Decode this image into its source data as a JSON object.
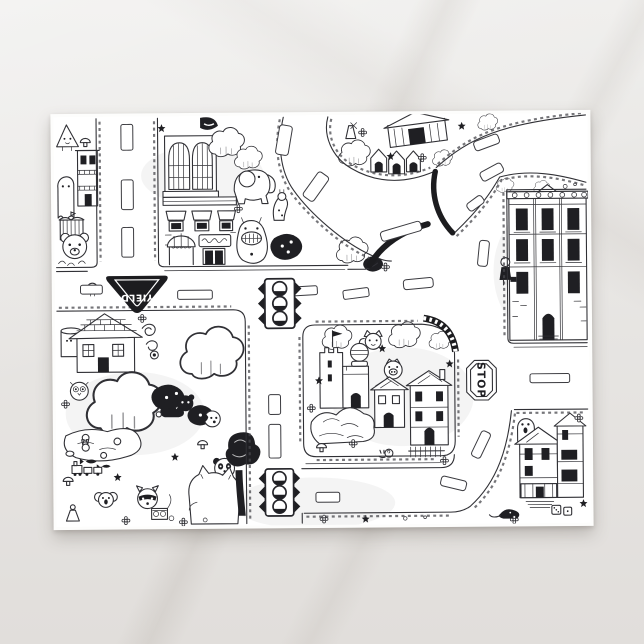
{
  "scene": {
    "type": "postcard product photo",
    "background_surface": "light marble countertop",
    "postcard": {
      "artwork_style": "black ink doodle road map of a whimsical town",
      "ink_color": "#1f1f23",
      "paper_color": "#ffffff",
      "signs": {
        "yield": "YIELD",
        "stop": "STOP"
      },
      "road_features": [
        "outlined dashed lane markings",
        "cobblestone curb ticks",
        "two traffic lights",
        "upside-down yield sign",
        "sideways stop octagon",
        "curved boulevard forking to the right edge",
        "right-angle turn to bottom road"
      ],
      "landmarks": [
        "gothic arched-window hall",
        "striped awning storefront",
        "ornate stone mansion",
        "victorian house with tower",
        "castle tower with flag and knight",
        "tiled-roof cottage",
        "tilted barn and gabled cottages",
        "pond with lily pads",
        "rock pile",
        "picket fence"
      ],
      "creatures": [
        "elephant",
        "grinning monster",
        "ghost",
        "bear",
        "panda",
        "koala",
        "raccoon with radio",
        "big white cat",
        "puppy",
        "owl",
        "pig",
        "hedgehog",
        "snail",
        "rat",
        "chick",
        "fish",
        "bunny",
        "giraffe"
      ]
    }
  },
  "colors": {
    "background": "#e9e6e3",
    "card_shadow": "rgba(70,62,55,0.25)"
  }
}
